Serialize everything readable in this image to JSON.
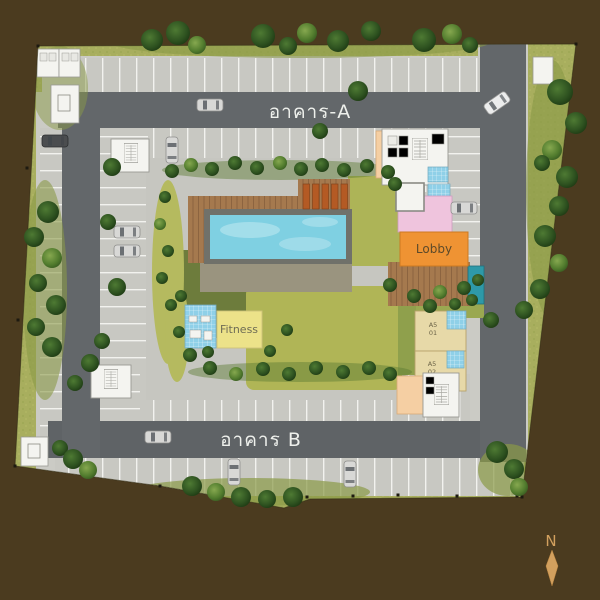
{
  "site": {
    "labels": {
      "building_a": "อาคาร-A",
      "building_b": "อาคาร B",
      "lobby": "Lobby",
      "fitness": "Fitness",
      "unit1_line1": "A5",
      "unit1_line2": "01",
      "unit2_line1": "A5",
      "unit2_line2": "02",
      "compass_north": "N"
    },
    "colors": {
      "background": "#4b3b1f",
      "grass": "#a8ae5e",
      "road": "#63676a",
      "concrete": "#cbcbc5",
      "walkway": "#c6c6c0",
      "building_white": "#f4f4f0",
      "peach": "#f5cfa3",
      "pink": "#efc4dd",
      "bath_blue": "#8fd0e8",
      "fitness_yellow": "#ece289",
      "unit_beige": "#e7d9a8",
      "lobby_orange": "#ef9333",
      "spa_teal": "#2e99a8",
      "deck_brown": "#a5794e",
      "lounger_orange": "#b45a24",
      "pool_water": "#7fd0e2",
      "lawn_dark": "#6d7c3c",
      "lawn_bright": "#b0b556",
      "compass_tan": "#d2a05e"
    }
  },
  "features": {
    "trees": [
      [
        152,
        40,
        11,
        "d"
      ],
      [
        178,
        33,
        12,
        "d"
      ],
      [
        197,
        45,
        9,
        "l"
      ],
      [
        263,
        36,
        12,
        "d"
      ],
      [
        288,
        46,
        9,
        "d"
      ],
      [
        307,
        33,
        10,
        "l"
      ],
      [
        338,
        41,
        11,
        "d"
      ],
      [
        371,
        31,
        10,
        "d"
      ],
      [
        424,
        40,
        12,
        "d"
      ],
      [
        452,
        34,
        10,
        "l"
      ],
      [
        470,
        45,
        8,
        "d"
      ],
      [
        560,
        92,
        13,
        "d"
      ],
      [
        576,
        123,
        11,
        "d"
      ],
      [
        552,
        150,
        10,
        "l"
      ],
      [
        567,
        177,
        11,
        "d"
      ],
      [
        542,
        163,
        8,
        "d"
      ],
      [
        559,
        206,
        10,
        "d"
      ],
      [
        545,
        236,
        11,
        "d"
      ],
      [
        559,
        263,
        9,
        "l"
      ],
      [
        540,
        289,
        10,
        "d"
      ],
      [
        524,
        310,
        9,
        "d"
      ],
      [
        48,
        212,
        11,
        "d"
      ],
      [
        34,
        237,
        10,
        "d"
      ],
      [
        52,
        258,
        10,
        "l"
      ],
      [
        38,
        283,
        9,
        "d"
      ],
      [
        56,
        305,
        10,
        "d"
      ],
      [
        36,
        327,
        9,
        "d"
      ],
      [
        52,
        347,
        10,
        "d"
      ],
      [
        90,
        363,
        9,
        "d"
      ],
      [
        75,
        383,
        8,
        "d"
      ],
      [
        60,
        448,
        8,
        "d"
      ],
      [
        73,
        459,
        10,
        "d"
      ],
      [
        88,
        470,
        9,
        "l"
      ],
      [
        192,
        486,
        10,
        "d"
      ],
      [
        216,
        492,
        9,
        "l"
      ],
      [
        241,
        497,
        10,
        "d"
      ],
      [
        267,
        499,
        9,
        "d"
      ],
      [
        293,
        497,
        10,
        "d"
      ],
      [
        497,
        452,
        11,
        "d"
      ],
      [
        514,
        469,
        10,
        "d"
      ],
      [
        519,
        487,
        9,
        "l"
      ],
      [
        112,
        167,
        9,
        "d"
      ],
      [
        358,
        91,
        10,
        "d"
      ],
      [
        320,
        131,
        8,
        "d"
      ],
      [
        108,
        222,
        8,
        "d"
      ],
      [
        117,
        287,
        9,
        "d"
      ],
      [
        102,
        341,
        8,
        "d"
      ],
      [
        491,
        320,
        8,
        "d"
      ],
      [
        172,
        171,
        7,
        "d"
      ],
      [
        191,
        165,
        7,
        "l"
      ],
      [
        212,
        169,
        7,
        "d"
      ],
      [
        235,
        163,
        7,
        "d"
      ],
      [
        257,
        168,
        7,
        "d"
      ],
      [
        280,
        163,
        7,
        "l"
      ],
      [
        301,
        169,
        7,
        "d"
      ],
      [
        322,
        165,
        7,
        "d"
      ],
      [
        344,
        170,
        7,
        "d"
      ],
      [
        367,
        166,
        7,
        "d"
      ],
      [
        388,
        172,
        7,
        "d"
      ],
      [
        165,
        197,
        6,
        "d"
      ],
      [
        160,
        224,
        6,
        "l"
      ],
      [
        168,
        251,
        6,
        "d"
      ],
      [
        162,
        278,
        6,
        "d"
      ],
      [
        171,
        305,
        6,
        "d"
      ],
      [
        179,
        332,
        6,
        "d"
      ],
      [
        190,
        355,
        7,
        "d"
      ],
      [
        210,
        368,
        7,
        "d"
      ],
      [
        236,
        374,
        7,
        "l"
      ],
      [
        263,
        369,
        7,
        "d"
      ],
      [
        289,
        374,
        7,
        "d"
      ],
      [
        316,
        368,
        7,
        "d"
      ],
      [
        343,
        372,
        7,
        "d"
      ],
      [
        369,
        368,
        7,
        "d"
      ],
      [
        390,
        374,
        7,
        "d"
      ],
      [
        395,
        184,
        7,
        "d"
      ],
      [
        390,
        285,
        7,
        "d"
      ],
      [
        414,
        296,
        7,
        "d"
      ],
      [
        440,
        292,
        7,
        "l"
      ],
      [
        464,
        288,
        7,
        "d"
      ],
      [
        478,
        280,
        6,
        "d"
      ],
      [
        430,
        306,
        7,
        "d"
      ],
      [
        455,
        304,
        6,
        "d"
      ],
      [
        472,
        300,
        6,
        "d"
      ],
      [
        181,
        296,
        6,
        "d"
      ],
      [
        208,
        352,
        6,
        "d"
      ],
      [
        270,
        351,
        6,
        "d"
      ],
      [
        287,
        330,
        6,
        "d"
      ]
    ],
    "cars": [
      [
        210,
        105,
        0,
        "silver"
      ],
      [
        497,
        103,
        -35,
        "white"
      ],
      [
        55,
        141,
        0,
        "dark"
      ],
      [
        172,
        150,
        90,
        "silver"
      ],
      [
        127,
        232,
        0,
        "silver"
      ],
      [
        127,
        251,
        0,
        "silver"
      ],
      [
        464,
        208,
        0,
        "silver"
      ],
      [
        158,
        437,
        0,
        "silver"
      ],
      [
        234,
        472,
        90,
        "silver"
      ],
      [
        350,
        474,
        90,
        "silver"
      ]
    ],
    "markers": [
      [
        38,
        46
      ],
      [
        576,
        44
      ],
      [
        27,
        168
      ],
      [
        18,
        320
      ],
      [
        15,
        466
      ],
      [
        160,
        486
      ],
      [
        307,
        497
      ],
      [
        353,
        496
      ],
      [
        398,
        495
      ],
      [
        457,
        496
      ],
      [
        517,
        496
      ],
      [
        522,
        497
      ]
    ],
    "patches": [
      [
        300,
        42,
        190,
        16,
        "#8a9a47",
        0.6
      ],
      [
        552,
        190,
        26,
        130,
        "#8a9a47",
        0.6
      ],
      [
        45,
        290,
        22,
        110,
        "#8a9a47",
        0.6
      ],
      [
        250,
        492,
        120,
        14,
        "#8a9a47",
        0.7
      ],
      [
        508,
        470,
        30,
        26,
        "#8a9a47",
        0.7
      ],
      [
        60,
        88,
        28,
        42,
        "#8a9a47",
        0.5
      ],
      [
        280,
        170,
        118,
        10,
        "#5c7a33",
        0.45
      ],
      [
        300,
        372,
        112,
        10,
        "#5c7a33",
        0.45
      ],
      [
        168,
        272,
        16,
        92,
        "#b5ba5f",
        1
      ],
      [
        177,
        332,
        12,
        50,
        "#b5ba5f",
        1
      ]
    ]
  }
}
